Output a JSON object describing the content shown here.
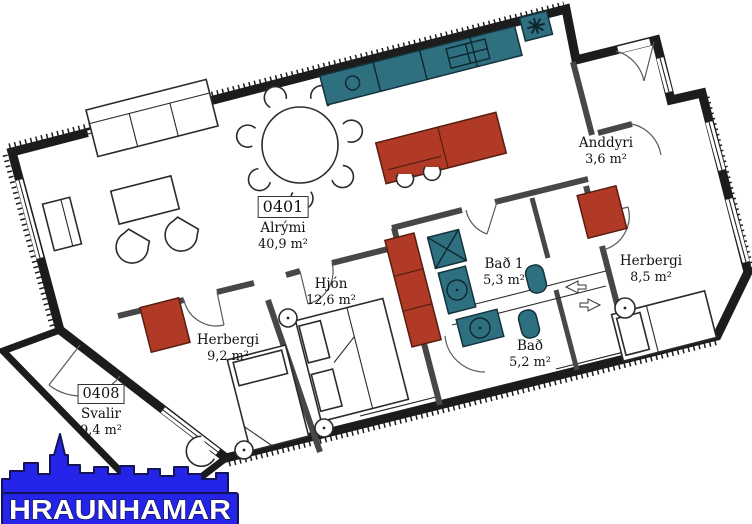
{
  "units": [
    {
      "number": "0401",
      "name": "Alrými",
      "area": "40,9 m²"
    },
    {
      "number": "0408",
      "name": "Svalir",
      "area": "9,4 m²"
    }
  ],
  "rooms": [
    {
      "name": "Anddyri",
      "area": "3,6 m²"
    },
    {
      "name": "Hjón",
      "area": "12,6 m²"
    },
    {
      "name": "Herbergi",
      "area": "9,2 m²"
    },
    {
      "name": "Bað 1",
      "area": "5,3 m²"
    },
    {
      "name": "Bað",
      "area": "5,2 m²"
    },
    {
      "name": "Herbergi",
      "area": "8,5 m²"
    }
  ],
  "logo": {
    "text": "HRAUNHAMAR"
  },
  "colors": {
    "wall": "#1c1c1c",
    "fixture_teal": "#2e6f80",
    "furniture_red": "#b13a27",
    "logo_blue": "#2424e8"
  }
}
